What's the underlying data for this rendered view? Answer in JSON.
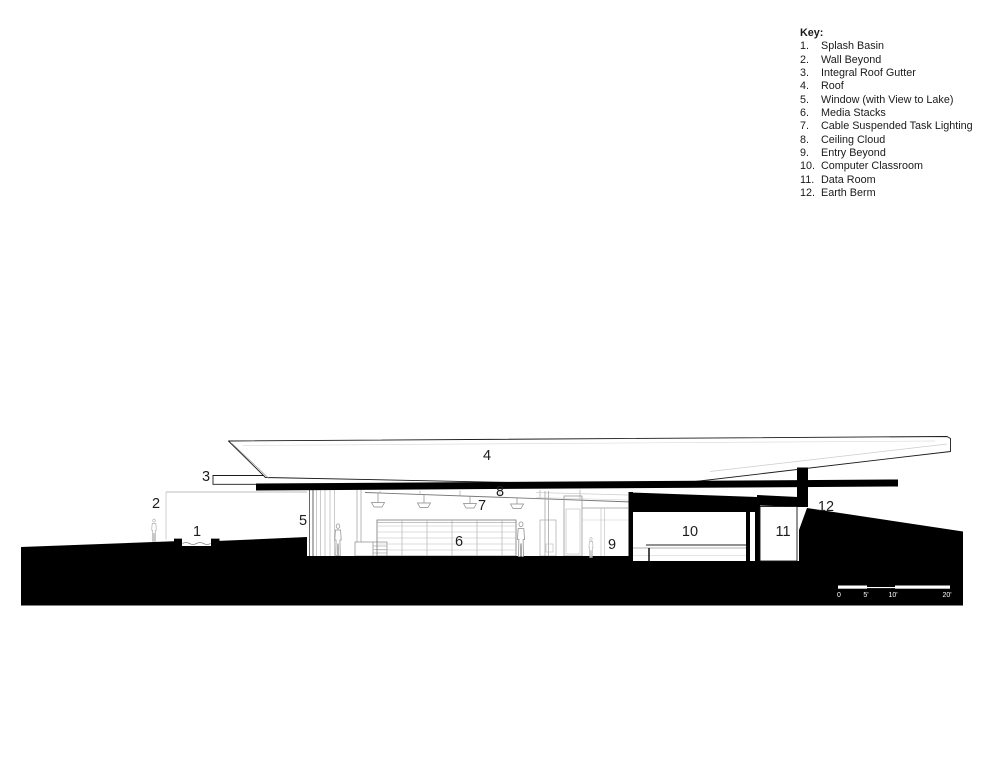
{
  "key": {
    "title": "Key:",
    "items": [
      {
        "num": "1.",
        "label": "Splash Basin"
      },
      {
        "num": "2.",
        "label": "Wall Beyond"
      },
      {
        "num": "3.",
        "label": "Integral Roof Gutter"
      },
      {
        "num": "4.",
        "label": "Roof"
      },
      {
        "num": "5.",
        "label": "Window (with View to Lake)"
      },
      {
        "num": "6.",
        "label": "Media Stacks"
      },
      {
        "num": "7.",
        "label": "Cable Suspended Task Lighting"
      },
      {
        "num": "8.",
        "label": "Ceiling Cloud"
      },
      {
        "num": "9.",
        "label": "Entry Beyond"
      },
      {
        "num": "10.",
        "label": "Computer Classroom"
      },
      {
        "num": "11.",
        "label": "Data Room"
      },
      {
        "num": "12.",
        "label": "Earth Berm"
      }
    ]
  },
  "drawing": {
    "callouts": [
      "1",
      "2",
      "3",
      "4",
      "5",
      "6",
      "7",
      "8",
      "9",
      "10",
      "11",
      "12"
    ]
  },
  "scale_bar": {
    "labels": [
      "0",
      "5'",
      "10'",
      "20'"
    ]
  },
  "colors": {
    "ink": "#000000",
    "poche": "#000000",
    "paper": "#ffffff",
    "light_line": "#9a9a9a"
  }
}
